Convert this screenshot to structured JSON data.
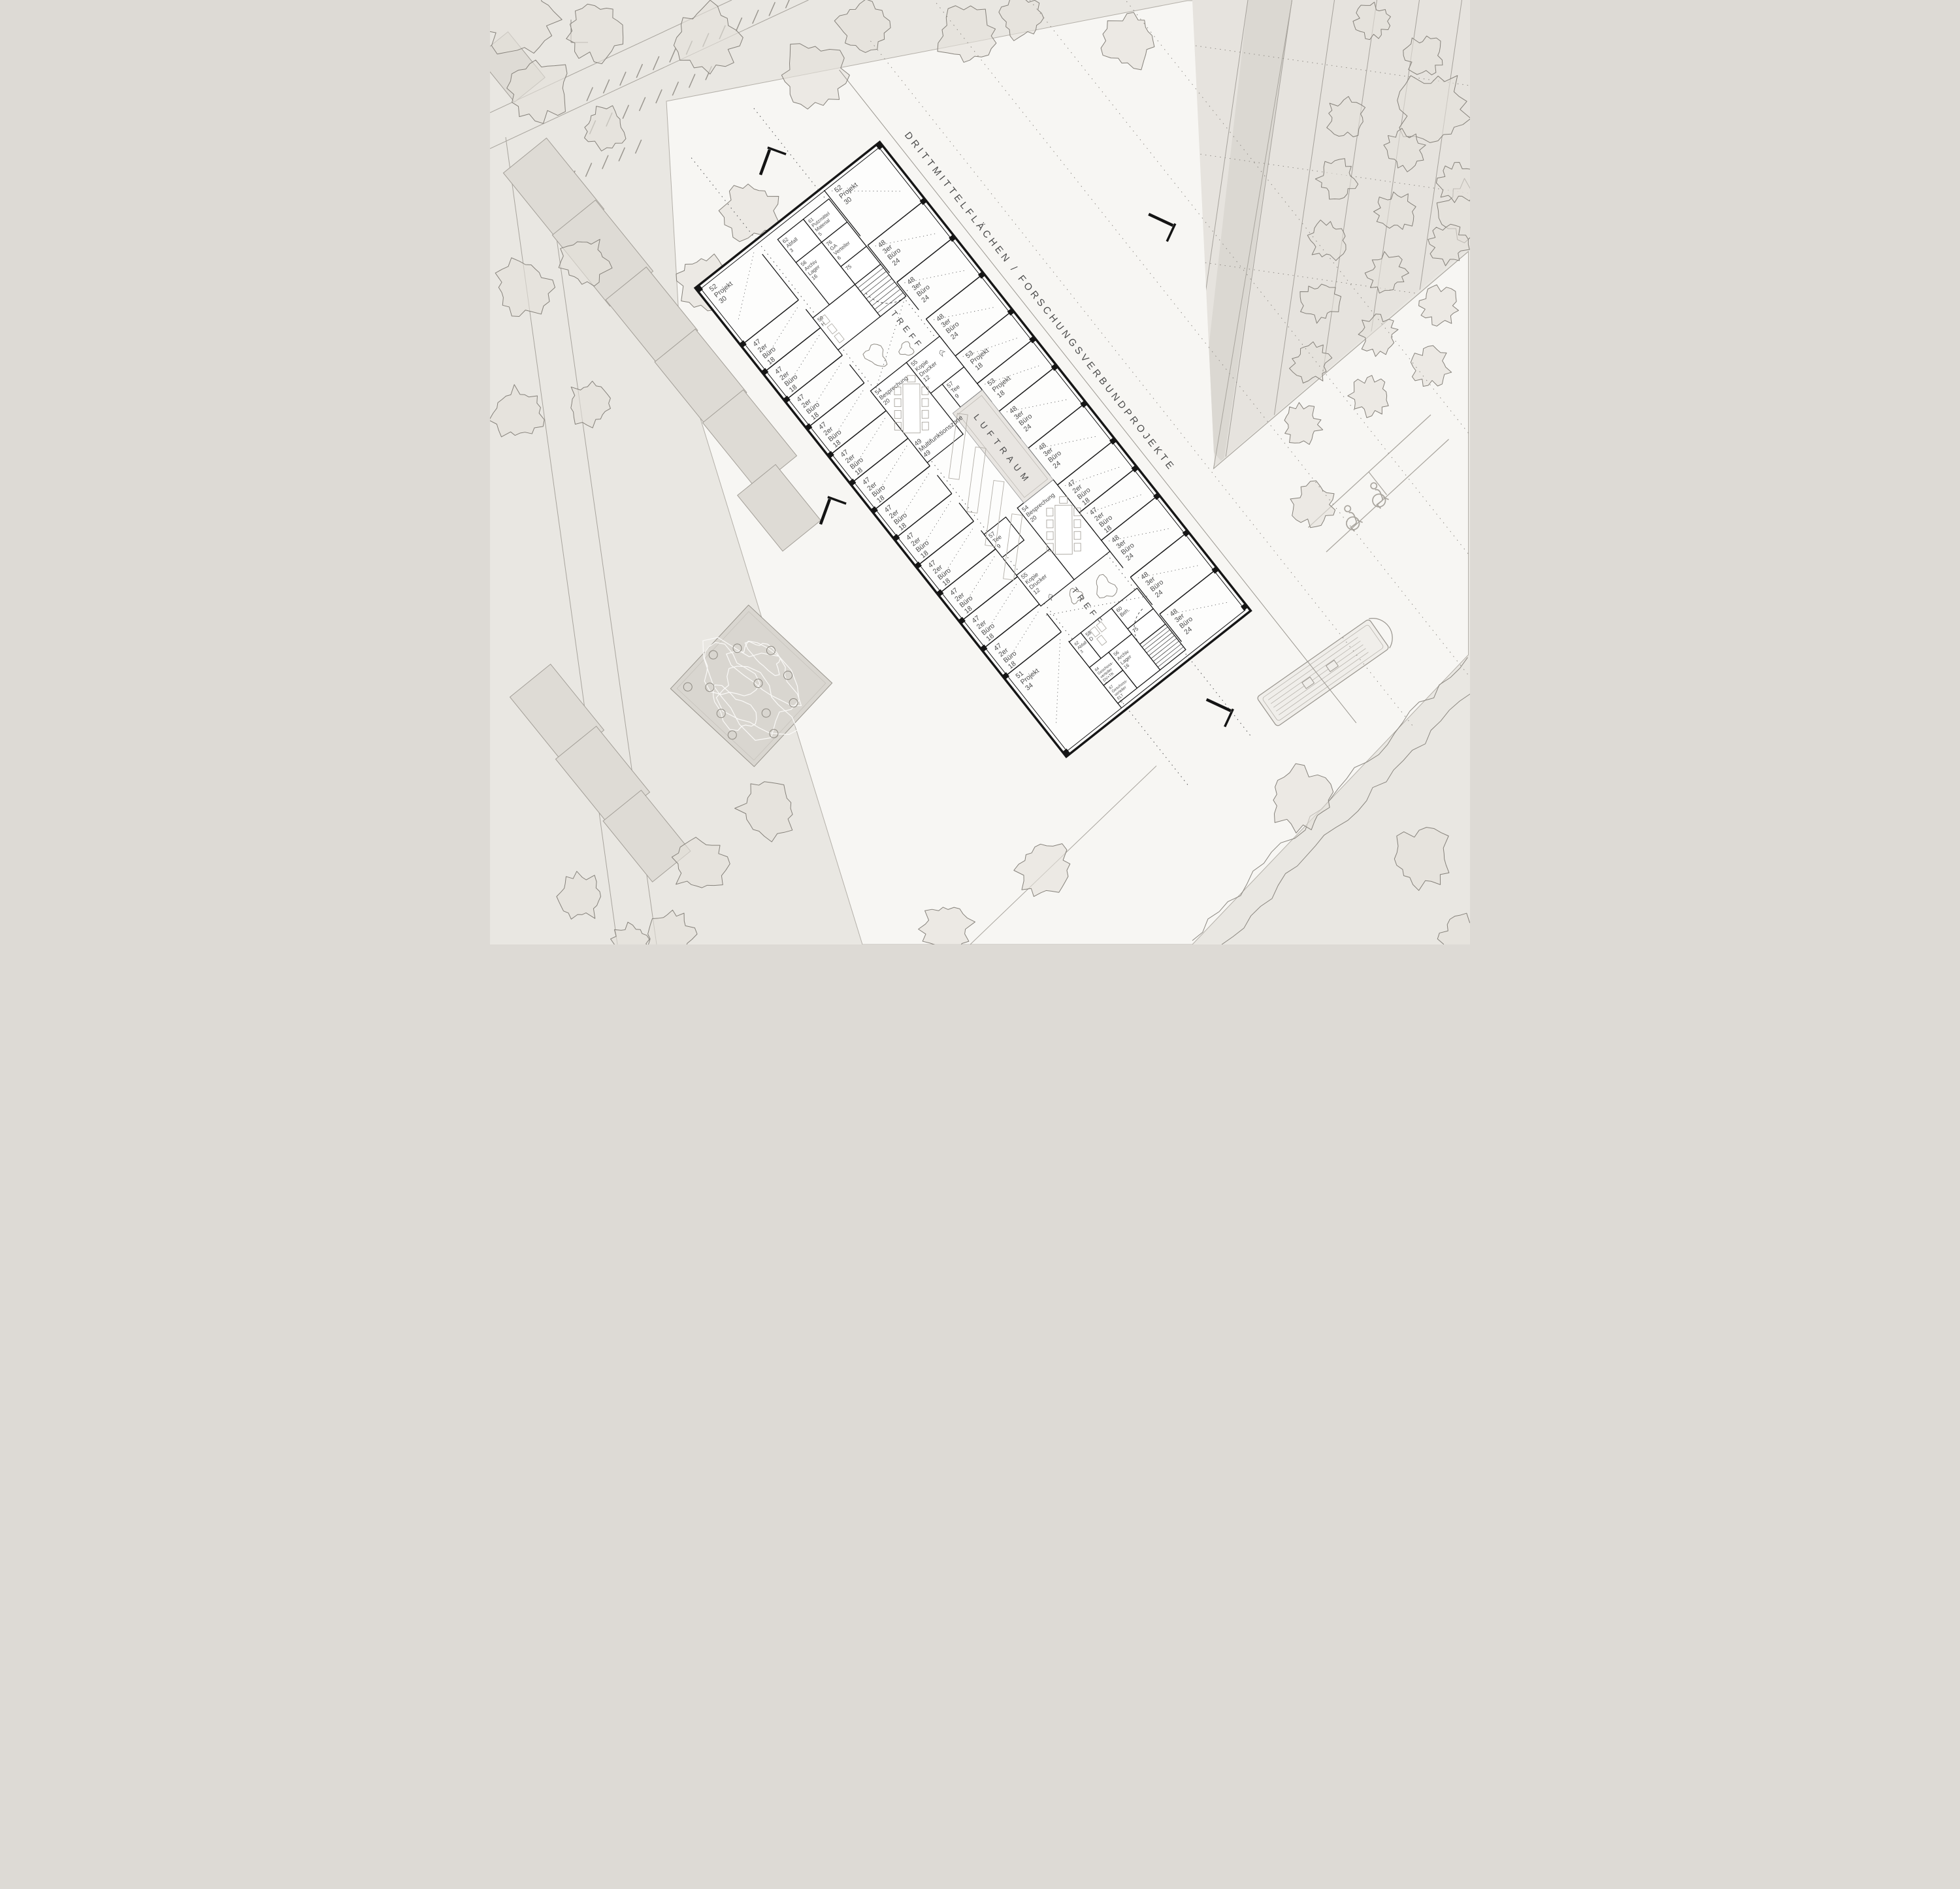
{
  "labels": {
    "band": "DRITTMITTELFLÄCHEN / FORSCHUNGSVERBUNDPROJEKTE",
    "treff": "TREFF",
    "luftraum": "LUFTRAUM"
  },
  "colors": {
    "background": "#eae8e4",
    "plaza": "#f7f6f3",
    "wall": "#161616",
    "atrium_fill": "#e8e5e1",
    "furniture": "#a8a49d",
    "label_text": "#4a4a4a"
  },
  "rooms": {
    "ne_row": [
      {
        "number": "52",
        "use": "Projekt",
        "area": "30"
      },
      {
        "number": "48",
        "use": "3er Büro",
        "area": "24"
      },
      {
        "number": "48",
        "use": "3er Büro",
        "area": "24"
      },
      {
        "number": "48",
        "use": "3er Büro",
        "area": "24"
      },
      {
        "number": "53",
        "use": "Projekt",
        "area": "18"
      },
      {
        "number": "53",
        "use": "Projekt",
        "area": "18"
      },
      {
        "number": "48",
        "use": "3er Büro",
        "area": "24"
      },
      {
        "number": "48",
        "use": "3er Büro",
        "area": "24"
      },
      {
        "number": "47",
        "use": "2er Büro",
        "area": "18"
      },
      {
        "number": "47",
        "use": "2er Büro",
        "area": "18"
      },
      {
        "number": "48",
        "use": "3er Büro",
        "area": "24"
      },
      {
        "number": "48",
        "use": "3er Büro",
        "area": "24"
      },
      {
        "number": "48",
        "use": "3er Büro",
        "area": "24"
      }
    ],
    "sw_row": [
      {
        "number": "52",
        "use": "Projekt",
        "area": "30"
      },
      {
        "number": "47",
        "use": "2er Büro",
        "area": "18"
      },
      {
        "number": "47",
        "use": "2er Büro",
        "area": "18"
      },
      {
        "number": "47",
        "use": "2er Büro",
        "area": "18"
      },
      {
        "number": "47",
        "use": "2er Büro",
        "area": "18"
      },
      {
        "number": "47",
        "use": "2er Büro",
        "area": "18"
      },
      {
        "number": "47",
        "use": "2er Büro",
        "area": "18"
      },
      {
        "number": "47",
        "use": "2er Büro",
        "area": "18"
      },
      {
        "number": "47",
        "use": "2er Büro",
        "area": "18"
      },
      {
        "number": "47",
        "use": "2er Büro",
        "area": "18"
      },
      {
        "number": "47",
        "use": "2er Büro",
        "area": "18"
      },
      {
        "number": "47",
        "use": "2er Büro",
        "area": "18"
      },
      {
        "number": "47",
        "use": "2er Büro",
        "area": "18"
      },
      {
        "number": "51",
        "use": "Projekt",
        "area": "34"
      }
    ],
    "core_nw": [
      {
        "number": "61",
        "use": "Putzmittel Material",
        "area": "5"
      },
      {
        "number": "76",
        "use": "GA Verteiler",
        "area": "6"
      },
      {
        "number": "75",
        "use": "",
        "area": ""
      },
      {
        "number": "56",
        "use": "Archiv Lager",
        "area": "16"
      },
      {
        "number": "62",
        "use": "Abfall",
        "area": "3"
      },
      {
        "number": "59",
        "use": "H",
        "area": ""
      }
    ],
    "core_se": [
      {
        "number": "60",
        "use": "Beh.",
        "area": ""
      },
      {
        "number": "75",
        "use": "",
        "area": ""
      },
      {
        "number": "58",
        "use": "D",
        "area": ""
      },
      {
        "number": "56",
        "use": "Archiv Lager",
        "area": "16"
      },
      {
        "number": "62",
        "use": "Abfall",
        "area": "3"
      },
      {
        "number": "64",
        "use": "Geschoss- verteiler DV+TK",
        "area": "5"
      },
      {
        "number": "67",
        "use": "Geschoss- verteiler ELT",
        "area": "5"
      }
    ],
    "center_nw": [
      {
        "number": "55",
        "use": "Kopie Drucker",
        "area": "12"
      },
      {
        "number": "57",
        "use": "Tee",
        "area": "9"
      },
      {
        "number": "54",
        "use": "Besprechung",
        "area": "20"
      }
    ],
    "center_se": [
      {
        "number": "55",
        "use": "Kopie Drucker",
        "area": "12"
      },
      {
        "number": "57",
        "use": "Tee",
        "area": "9"
      },
      {
        "number": "54",
        "use": "Besprechung",
        "area": "20"
      }
    ],
    "multizone": {
      "number": "49",
      "use": "Multifunktionszone",
      "area": "49"
    }
  }
}
